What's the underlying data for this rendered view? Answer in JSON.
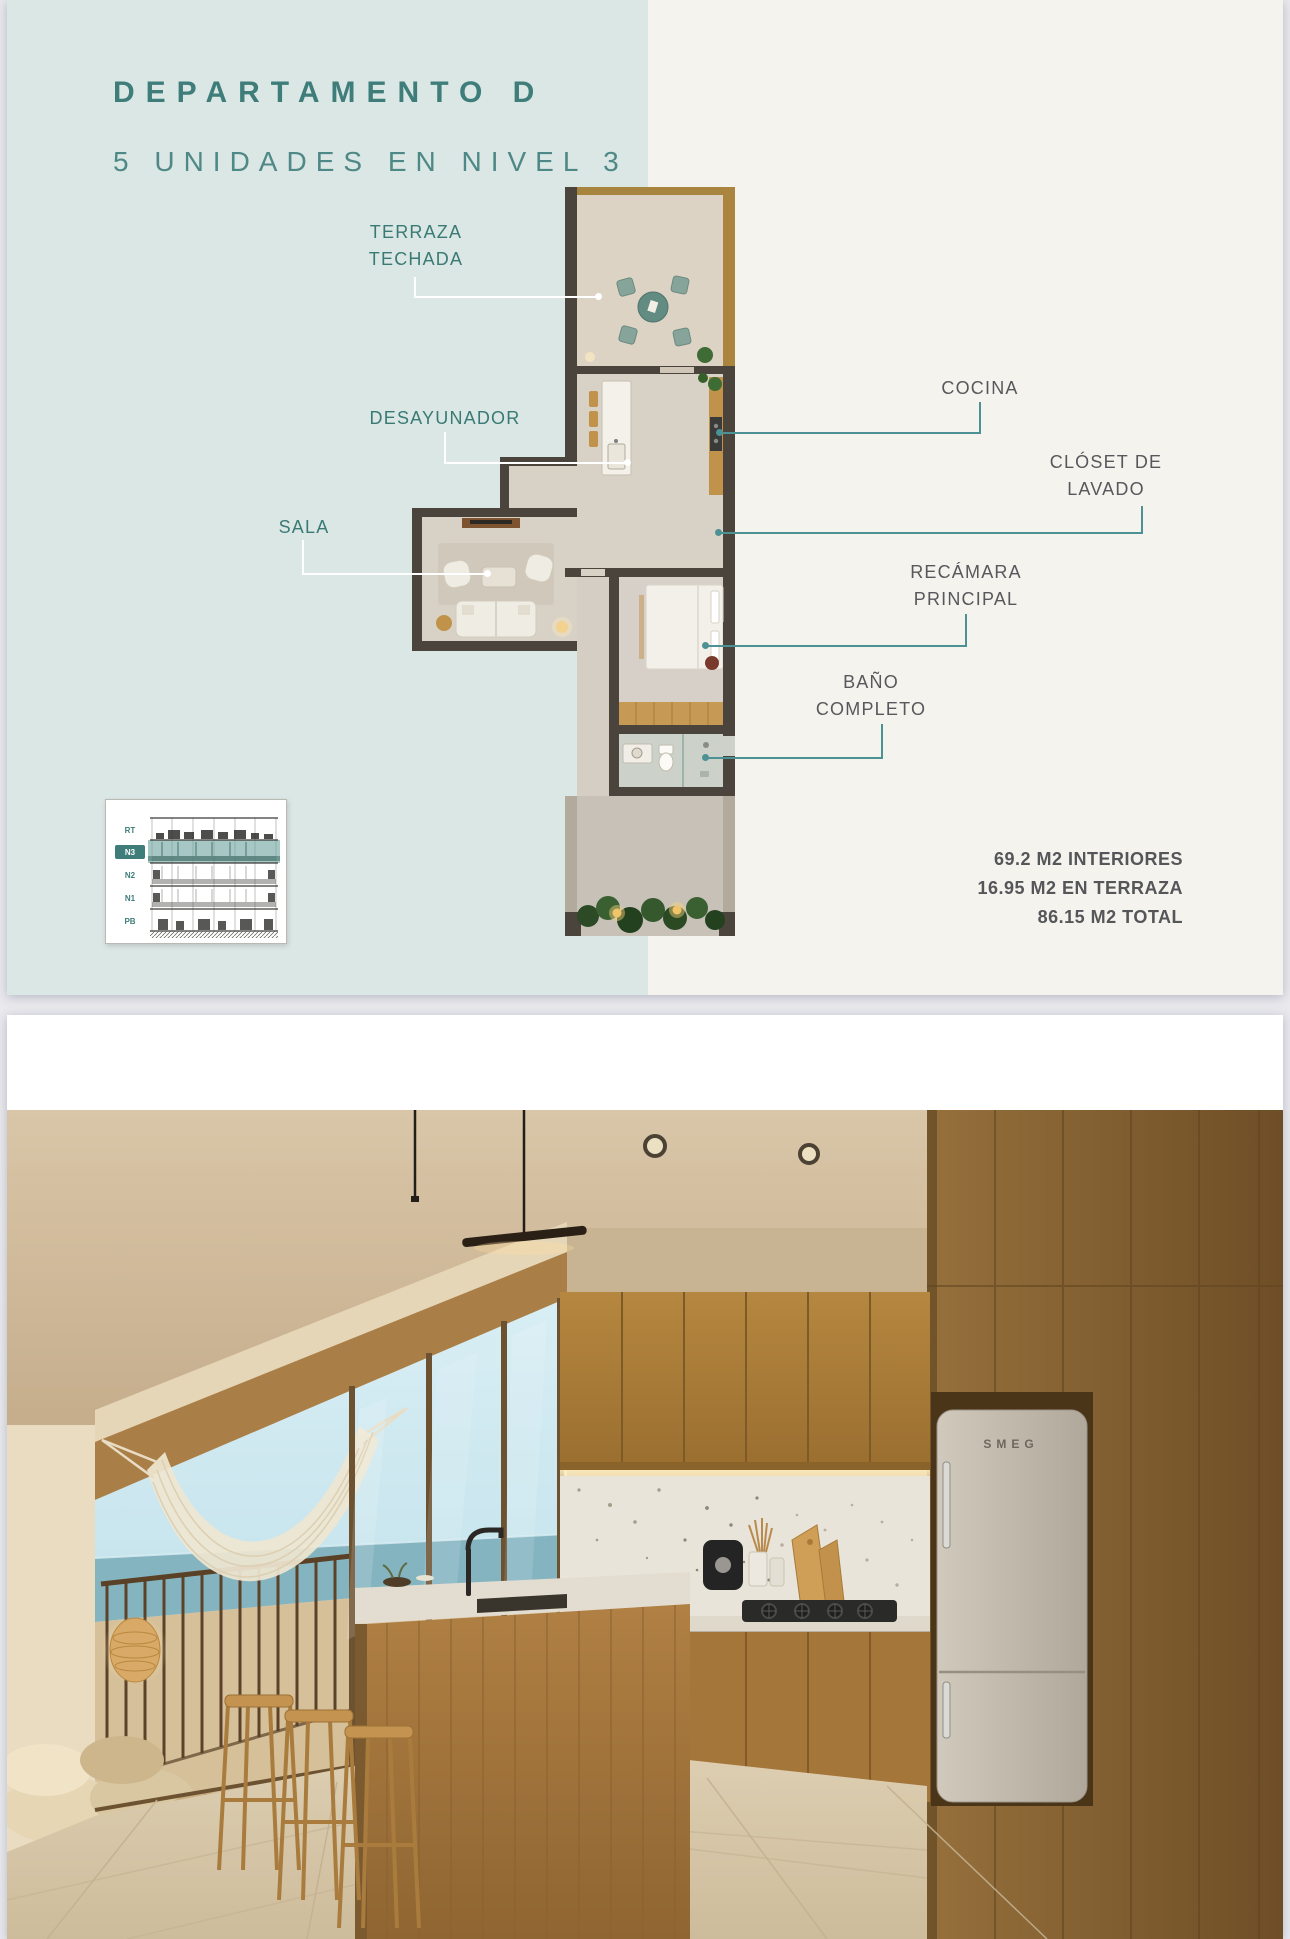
{
  "page1": {
    "title": "DEPARTAMENTO D",
    "subtitle": "5 UNIDADES EN NIVEL 3",
    "plan_labels": {
      "terraza_techada": {
        "line1": "TERRAZA",
        "line2": "TECHADA"
      },
      "desayunador": {
        "line1": "DESAYUNADOR"
      },
      "sala": {
        "line1": "SALA"
      },
      "cocina": {
        "line1": "COCINA"
      },
      "closet_de_lavado": {
        "line1": "CLÓSET DE",
        "line2": "LAVADO"
      },
      "recamara_principal": {
        "line1": "RECÁMARA",
        "line2": "PRINCIPAL"
      },
      "bano_completo": {
        "line1": "BAÑO",
        "line2": "COMPLETO"
      }
    },
    "elevation_key": {
      "levels": [
        "RT",
        "N3",
        "N2",
        "N1",
        "PB"
      ],
      "highlighted_level": "N3"
    },
    "areas": {
      "interiors": "69.2 M2 INTERIORES",
      "terrace": "16.95 M2 EN TERRAZA",
      "total": "86.15 M2 TOTAL"
    }
  },
  "page2": {
    "fridge_brand": "SMEG"
  },
  "colors": {
    "mint_panel": "#dbe7e4",
    "cream_panel": "#f5f3ed",
    "title_teal": "#3e7d7a",
    "subtitle_teal": "#4f8987",
    "label_teal": "#3a7a75",
    "label_gray": "#57585c",
    "stats_gray": "#55565a",
    "leader_white": "#ffffff",
    "leader_teal": "#4c9193",
    "plan_wall": "#4a443c",
    "plan_wood": "#c0924a",
    "elevation_highlight": "#6fa49f",
    "page_gap": "#e9e9ee"
  }
}
